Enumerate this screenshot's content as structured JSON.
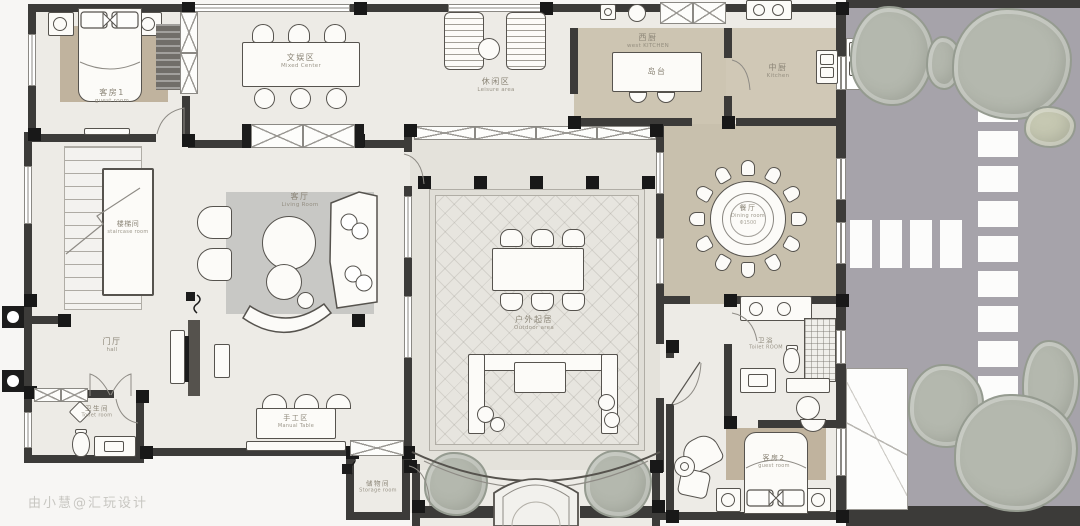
{
  "page": {
    "watermark": "由小慧@汇玩设计"
  },
  "colors": {
    "wall": "#3c3b39",
    "floor": "#edebe6",
    "floor_beige": "#cdc5b2",
    "floor_dining": "#c8c0ad",
    "rug_brown": "#c0b39e",
    "rug_gray": "#c8c8c5",
    "garden_ground": "#a6a3aa",
    "tree": "#b4b8ae",
    "stone": "#fcfcfb",
    "label_text": "#8b8577"
  },
  "rooms": {
    "guest1": {
      "zh": "客房1",
      "en": "guest room"
    },
    "fun": {
      "zh": "文娱区",
      "en": "Mixed Center"
    },
    "leisure": {
      "zh": "休闲区",
      "en": "Leisure area"
    },
    "wkitchen": {
      "zh": "西厨",
      "en": "west KITCHEN"
    },
    "island": {
      "zh": "岛台",
      "en": ""
    },
    "kitchen": {
      "zh": "中厨",
      "en": "Kitchen"
    },
    "stairs": {
      "zh": "楼梯间",
      "en": "staircase room"
    },
    "living": {
      "zh": "客厅",
      "en": "Living Room"
    },
    "hall": {
      "zh": "门厅",
      "en": "hall"
    },
    "wc1": {
      "zh": "卫生间",
      "en": "Toilet room"
    },
    "craft": {
      "zh": "手工区",
      "en": "Manual Table"
    },
    "storage": {
      "zh": "储物间",
      "en": "Storage room"
    },
    "outdoor": {
      "zh": "户外起居",
      "en": "Outdoor area"
    },
    "dining": {
      "zh": "餐厅",
      "en": "Dining room",
      "dim": "Φ1500"
    },
    "bath": {
      "zh": "卫浴",
      "en": "Toilet ROOM"
    },
    "guest2": {
      "zh": "客房2",
      "en": "guest room"
    }
  }
}
